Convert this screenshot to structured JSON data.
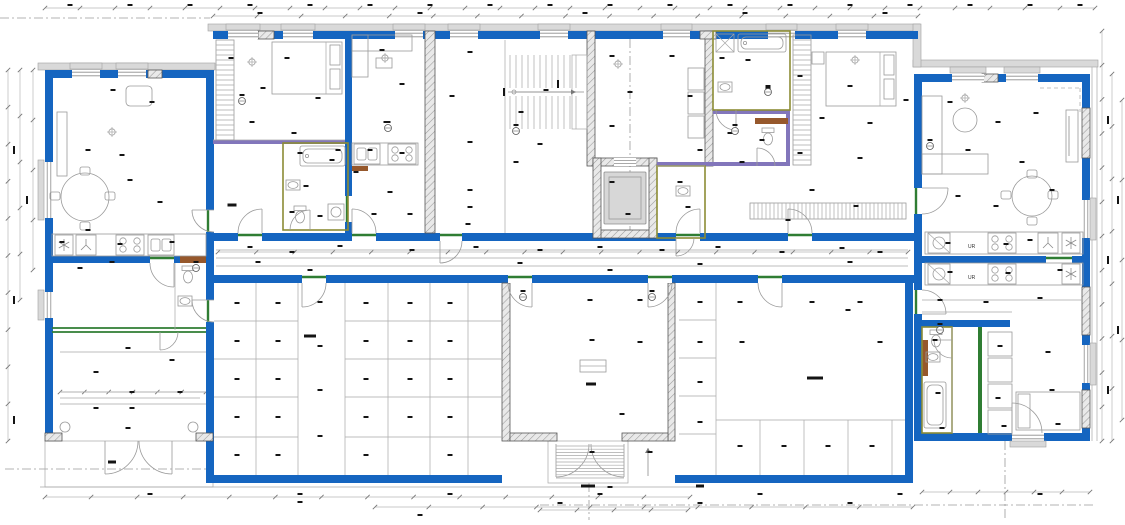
{
  "drawing": {
    "type": "architectural-floor-plan",
    "kitchen": {
      "fridge_label": "UR"
    }
  },
  "colors": {
    "wall_blue": "#1565C0",
    "hatch_bg": "#e9e9e9",
    "hatch_line": "#9a9a9a",
    "hatch_stroke": "#555555",
    "existing_band": "#d9d9d9",
    "existing_band_line": "#a0a0a0",
    "thin_line": "#a8a8a8",
    "mid_line": "#8c8c8c",
    "furniture_line": "#9a9a9a",
    "green_accent": "#2f7d33",
    "olive_accent": "#8c8c35",
    "purple_accent": "#8276bb",
    "brown_accent": "#96582c",
    "label_ink": "#141414",
    "dim_line": "#b8b8b8",
    "elevator_car": "#d7d7d7"
  },
  "dim_strips": {
    "horizontal": [
      [
        45,
        1095,
        8,
        30
      ],
      [
        213,
        918,
        16,
        16
      ],
      [
        45,
        690,
        497,
        14
      ],
      [
        375,
        913,
        507,
        10
      ],
      [
        922,
        1090,
        492,
        6
      ],
      [
        218,
        908,
        252,
        18
      ],
      [
        60,
        206,
        392,
        6
      ],
      [
        540,
        688,
        510,
        4
      ]
    ],
    "vertical": [
      [
        70,
        441,
        8,
        10
      ],
      [
        70,
        300,
        20,
        5
      ],
      [
        31,
        441,
        1102,
        12
      ],
      [
        74,
        441,
        1112,
        7
      ],
      [
        100,
        420,
        1122,
        4
      ],
      [
        70,
        270,
        33,
        4
      ]
    ]
  },
  "tags": [
    [
      242,
      101
    ],
    [
      388,
      128
    ],
    [
      516,
      131
    ],
    [
      735,
      131
    ],
    [
      768,
      92
    ],
    [
      930,
      146
    ],
    [
      523,
      297
    ],
    [
      652,
      297
    ],
    [
      196,
      268
    ],
    [
      940,
      330
    ]
  ],
  "annotation_marks": [
    [
      70,
      5
    ],
    [
      130,
      5
    ],
    [
      190,
      5
    ],
    [
      250,
      5
    ],
    [
      310,
      5
    ],
    [
      370,
      5
    ],
    [
      430,
      5
    ],
    [
      490,
      5
    ],
    [
      550,
      5
    ],
    [
      610,
      5
    ],
    [
      670,
      5
    ],
    [
      730,
      5
    ],
    [
      790,
      5
    ],
    [
      850,
      5
    ],
    [
      910,
      5
    ],
    [
      970,
      5
    ],
    [
      1030,
      5
    ],
    [
      1080,
      5
    ],
    [
      260,
      13
    ],
    [
      420,
      13
    ],
    [
      585,
      13
    ],
    [
      745,
      13
    ],
    [
      885,
      13
    ],
    [
      113,
      90
    ],
    [
      152,
      102
    ],
    [
      88,
      150
    ],
    [
      122,
      155
    ],
    [
      130,
      180
    ],
    [
      160,
      202
    ],
    [
      88,
      230
    ],
    [
      62,
      242
    ],
    [
      120,
      244
    ],
    [
      172,
      242
    ],
    [
      112,
      262
    ],
    [
      80,
      268
    ],
    [
      231,
      58
    ],
    [
      263,
      88
    ],
    [
      287,
      58
    ],
    [
      318,
      98
    ],
    [
      252,
      122
    ],
    [
      232,
      205,
      9,
      3
    ],
    [
      294,
      133
    ],
    [
      300,
      153
    ],
    [
      332,
      160
    ],
    [
      306,
      186
    ],
    [
      292,
      212
    ],
    [
      320,
      216
    ],
    [
      338,
      150
    ],
    [
      382,
      50
    ],
    [
      402,
      84
    ],
    [
      386,
      122
    ],
    [
      370,
      150
    ],
    [
      402,
      153
    ],
    [
      390,
      192
    ],
    [
      374,
      214
    ],
    [
      410,
      214
    ],
    [
      356,
      172
    ],
    [
      470,
      52
    ],
    [
      452,
      96
    ],
    [
      521,
      112
    ],
    [
      546,
      90
    ],
    [
      470,
      142
    ],
    [
      540,
      144
    ],
    [
      516,
      162
    ],
    [
      470,
      190
    ],
    [
      470,
      207
    ],
    [
      468,
      224
    ],
    [
      504,
      92,
      2,
      8
    ],
    [
      558,
      84,
      2,
      8
    ],
    [
      612,
      56
    ],
    [
      630,
      92
    ],
    [
      612,
      126
    ],
    [
      672,
      56
    ],
    [
      690,
      96
    ],
    [
      612,
      182
    ],
    [
      628,
      214
    ],
    [
      680,
      182
    ],
    [
      688,
      207
    ],
    [
      700,
      150
    ],
    [
      722,
      58
    ],
    [
      748,
      60
    ],
    [
      768,
      88
    ],
    [
      730,
      133
    ],
    [
      762,
      140
    ],
    [
      742,
      162
    ],
    [
      800,
      76
    ],
    [
      850,
      86
    ],
    [
      822,
      118
    ],
    [
      870,
      123
    ],
    [
      800,
      153
    ],
    [
      860,
      158
    ],
    [
      812,
      190
    ],
    [
      856,
      206
    ],
    [
      788,
      220
    ],
    [
      906,
      100
    ],
    [
      950,
      102
    ],
    [
      998,
      122
    ],
    [
      1036,
      113
    ],
    [
      968,
      150
    ],
    [
      1022,
      162
    ],
    [
      958,
      196
    ],
    [
      996,
      206
    ],
    [
      1052,
      190
    ],
    [
      948,
      243
    ],
    [
      1006,
      244
    ],
    [
      1030,
      240
    ],
    [
      250,
      247
    ],
    [
      292,
      252
    ],
    [
      340,
      246
    ],
    [
      412,
      250
    ],
    [
      476,
      247
    ],
    [
      540,
      250
    ],
    [
      600,
      247
    ],
    [
      662,
      250
    ],
    [
      718,
      247
    ],
    [
      782,
      252
    ],
    [
      842,
      248
    ],
    [
      880,
      252
    ],
    [
      258,
      262
    ],
    [
      520,
      263
    ],
    [
      700,
      264
    ],
    [
      850,
      262
    ],
    [
      310,
      270
    ],
    [
      610,
      270
    ],
    [
      950,
      272
    ],
    [
      1008,
      273
    ],
    [
      1060,
      270
    ],
    [
      940,
      300
    ],
    [
      986,
      302
    ],
    [
      1040,
      298
    ],
    [
      935,
      340
    ],
    [
      1000,
      346
    ],
    [
      1048,
      352
    ],
    [
      938,
      393
    ],
    [
      998,
      398
    ],
    [
      1052,
      390
    ],
    [
      942,
      428
    ],
    [
      1004,
      426
    ],
    [
      1058,
      424
    ],
    [
      237,
      303
    ],
    [
      278,
      303
    ],
    [
      237,
      341
    ],
    [
      278,
      341
    ],
    [
      237,
      379
    ],
    [
      278,
      379
    ],
    [
      237,
      417
    ],
    [
      278,
      417
    ],
    [
      237,
      455
    ],
    [
      278,
      455
    ],
    [
      320,
      302
    ],
    [
      320,
      346
    ],
    [
      320,
      390
    ],
    [
      320,
      436
    ],
    [
      366,
      303
    ],
    [
      410,
      303
    ],
    [
      366,
      341
    ],
    [
      410,
      341
    ],
    [
      366,
      379
    ],
    [
      410,
      379
    ],
    [
      366,
      417
    ],
    [
      410,
      417
    ],
    [
      366,
      455
    ],
    [
      450,
      303
    ],
    [
      450,
      341
    ],
    [
      450,
      379
    ],
    [
      450,
      417
    ],
    [
      450,
      455
    ],
    [
      310,
      336,
      12,
      3
    ],
    [
      700,
      302
    ],
    [
      740,
      302
    ],
    [
      700,
      342
    ],
    [
      700,
      382
    ],
    [
      700,
      422
    ],
    [
      740,
      446
    ],
    [
      784,
      446
    ],
    [
      828,
      446
    ],
    [
      872,
      446
    ],
    [
      815,
      378,
      16,
      3
    ],
    [
      742,
      342
    ],
    [
      860,
      302
    ],
    [
      812,
      302
    ],
    [
      880,
      342
    ],
    [
      848,
      310
    ],
    [
      590,
      300
    ],
    [
      640,
      300
    ],
    [
      592,
      340
    ],
    [
      640,
      342
    ],
    [
      591,
      384,
      10,
      3
    ],
    [
      622,
      414
    ],
    [
      592,
      452
    ],
    [
      588,
      486,
      14,
      3
    ],
    [
      700,
      486,
      8,
      3
    ],
    [
      650,
      452
    ],
    [
      128,
      348
    ],
    [
      172,
      360
    ],
    [
      96,
      372
    ],
    [
      132,
      392
    ],
    [
      180,
      392
    ],
    [
      96,
      408
    ],
    [
      132,
      408
    ],
    [
      128,
      428
    ],
    [
      112,
      462,
      8,
      3
    ],
    [
      150,
      494
    ],
    [
      300,
      494
    ],
    [
      450,
      494
    ],
    [
      600,
      494
    ],
    [
      760,
      494
    ],
    [
      900,
      494
    ],
    [
      1040,
      494
    ],
    [
      300,
      502
    ],
    [
      560,
      503
    ],
    [
      700,
      503
    ],
    [
      850,
      503
    ],
    [
      420,
      515
    ],
    [
      610,
      487
    ],
    [
      14,
      150,
      2,
      8
    ],
    [
      14,
      300,
      2,
      8
    ],
    [
      14,
      420,
      2,
      8
    ],
    [
      27,
      200,
      2,
      8
    ],
    [
      1108,
      120,
      2,
      8
    ],
    [
      1108,
      260,
      2,
      8
    ],
    [
      1108,
      390,
      2,
      8
    ],
    [
      1118,
      200,
      2,
      8
    ],
    [
      1118,
      330,
      2,
      8
    ]
  ]
}
